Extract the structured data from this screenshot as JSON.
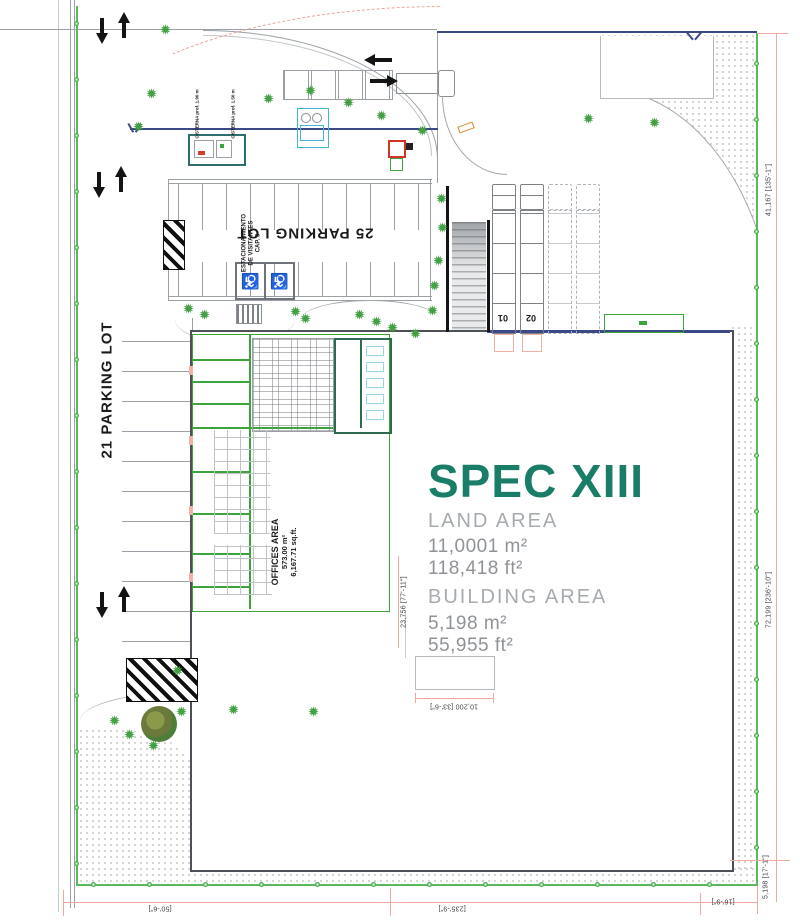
{
  "brand": {
    "title": "SPEC XIII",
    "accent_color": "#1A7D68"
  },
  "areas": {
    "land": {
      "label": "LAND AREA",
      "metric": "11,0001 m²",
      "imperial": "118,418 ft²"
    },
    "building": {
      "label": "BUILDING AREA",
      "metric": "5,198 m²",
      "imperial": "55,955 ft²"
    },
    "offices": {
      "label": "OFFICES AREA",
      "metric": "573.00 m²",
      "imperial": "6,167.71 sq.ft."
    }
  },
  "parking": {
    "north": "25 PARKING LOT",
    "west": "21 PARKING LOT",
    "visitor": {
      "line1": "ESTACIONAMIENTO",
      "line2": "DE VISITANTES",
      "line3": "CAP. 3"
    }
  },
  "utilities": {
    "cistern_1": "CISTERNA prof. 1.90 m",
    "cistern_2": "CISTERNA prof. 1.50 m"
  },
  "docks": {
    "bay_1": "01",
    "bay_2": "02"
  },
  "dims": {
    "right_top": "41,167 [135'-1\"]",
    "right_mid": "72,199 [236'-10\"]",
    "right_bottom": "5,198 [17'-1\"]",
    "west_wall": "23,756 [77'-11\"]",
    "notch": "10,200 [33'-6\"]",
    "bottom_left": "[50'-6\"]",
    "bottom_mid": "[235'-9\"]",
    "bottom_right": "[16'-9\"]"
  },
  "icons": {
    "handicap": "♿"
  },
  "colors": {
    "accent": "#1A7D68",
    "office_walls": "#3BA43B",
    "boundary": "#5CB85C",
    "dimension_lines": "#F0A9A0",
    "utility_navy": "#3B4A86"
  }
}
